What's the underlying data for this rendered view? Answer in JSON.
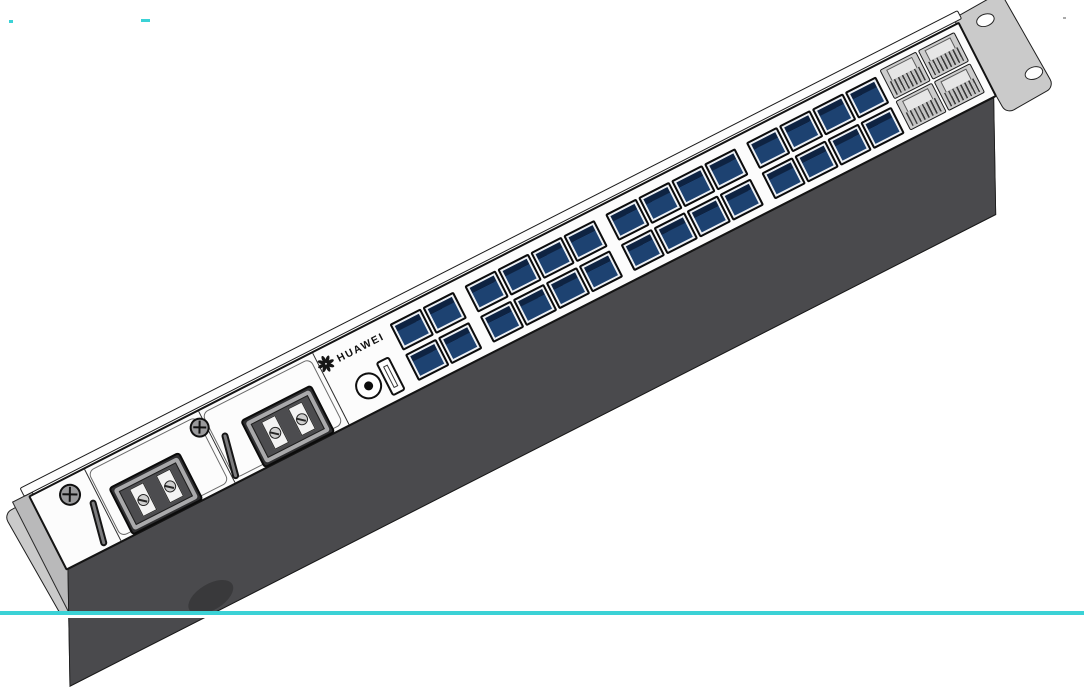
{
  "device": {
    "brand": "HUAWEI",
    "description": "1U rack-mount network switch, isometric front view"
  },
  "panel": {
    "sections": [
      "blank-left",
      "power-module-1",
      "power-module-2",
      "main-port-area"
    ]
  },
  "power_modules": [
    {
      "id": 1,
      "terminals": 2
    },
    {
      "id": 2,
      "terminals": 2
    }
  ],
  "ports": {
    "sfp": {
      "rows": 2,
      "groups": [
        2,
        4,
        4,
        4
      ],
      "total": 28
    },
    "rj45": {
      "rows": 2,
      "cols": 2,
      "total": 4
    },
    "usb": 1,
    "round_port": 1
  },
  "hardware": {
    "panel_screws": 2,
    "left_ear_holes": 3,
    "right_ear_holes": 2,
    "chassis_feet": 1
  },
  "colors": {
    "panel": "#fcfcfc",
    "underside": "#4a4a4d",
    "ear": "#cacaca",
    "outline": "#141414",
    "sfp_face": "#1d4271",
    "sfp_shade": "#0e2342",
    "accent_line": "#3bd2d6"
  }
}
